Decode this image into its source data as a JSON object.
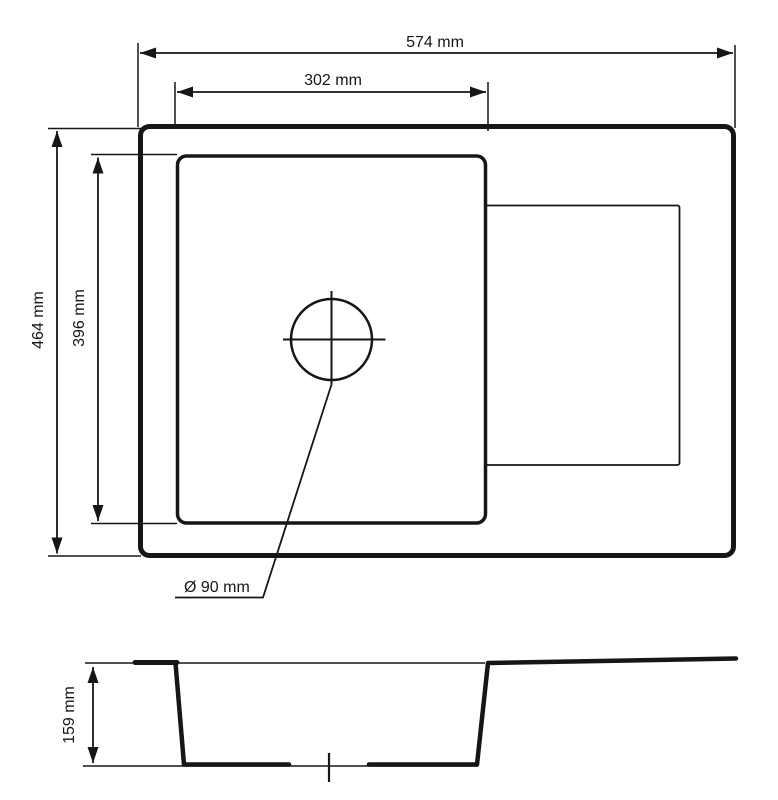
{
  "page": {
    "background": "#ffffff",
    "line_color": "#161616",
    "description": "Technical dimension drawing of a kitchen sink: top view with single bowl, drainer area and drain hole, plus side cross-section view"
  },
  "top_view": {
    "labels": {
      "overall_width": "574 mm",
      "bowl_width": "302 mm",
      "overall_depth": "464 mm",
      "bowl_depth": "396 mm",
      "drain_diameter": "Ø 90 mm"
    },
    "values_mm": {
      "overall_width": 574,
      "bowl_width": 302,
      "overall_depth": 464,
      "bowl_depth": 396,
      "drain_diameter": 90
    }
  },
  "section_view": {
    "labels": {
      "bowl_height": "159 mm"
    },
    "values_mm": {
      "bowl_height": 159
    }
  }
}
